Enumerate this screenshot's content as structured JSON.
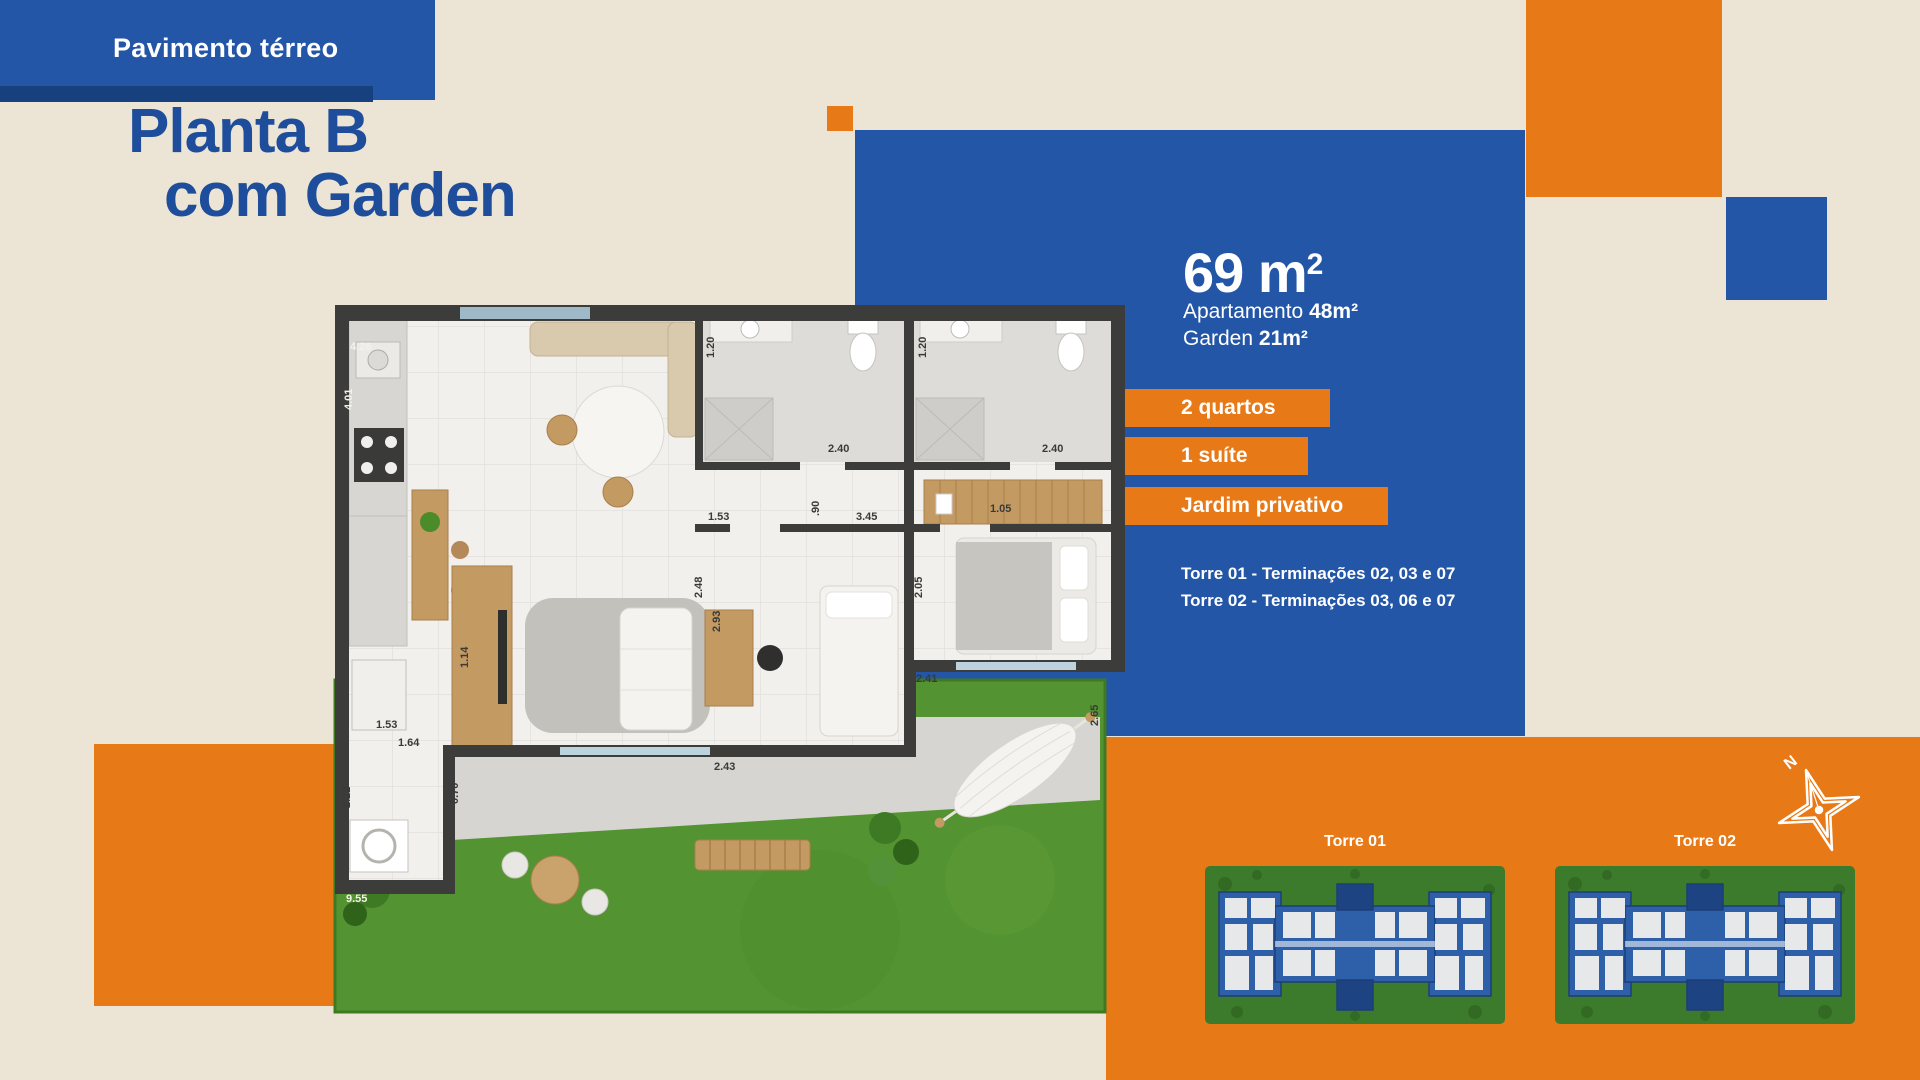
{
  "banner": {
    "label": "Pavimento térreo"
  },
  "title": {
    "line1": "Planta B",
    "line2": "com Garden"
  },
  "info_panel": {
    "area_value": "69 m",
    "area_sup": "2",
    "apartment_label": "Apartamento ",
    "apartment_value": "48m²",
    "garden_label": "Garden ",
    "garden_value": "21m²",
    "badges": [
      "2 quartos",
      "1 suíte",
      "Jardim privativo"
    ],
    "tower_lines": [
      "Torre 01 -  Terminações 02, 03 e 07",
      "Torre 02 -  Terminações 03, 06 e 07"
    ]
  },
  "site_panel": {
    "tower1_label": "Torre 01",
    "tower2_label": "Torre 02",
    "compass_label": "N"
  },
  "floorplan": {
    "measurements": [
      {
        "t": "4.26",
        "x": 50,
        "y": 70,
        "r": 0,
        "c": "w"
      },
      {
        "t": "4.01",
        "x": 52,
        "y": 130,
        "r": -90,
        "c": "w"
      },
      {
        "t": "1.20",
        "x": 414,
        "y": 78,
        "r": -90,
        "c": "d"
      },
      {
        "t": "1.20",
        "x": 626,
        "y": 78,
        "r": -90,
        "c": "d"
      },
      {
        "t": "2.40",
        "x": 528,
        "y": 172,
        "r": 0,
        "c": "d"
      },
      {
        "t": "2.40",
        "x": 742,
        "y": 172,
        "r": 0,
        "c": "d"
      },
      {
        "t": "1.53",
        "x": 408,
        "y": 240,
        "r": 0,
        "c": "d"
      },
      {
        "t": ".90",
        "x": 519,
        "y": 236,
        "r": -90,
        "c": "d"
      },
      {
        "t": "3.45",
        "x": 556,
        "y": 240,
        "r": 0,
        "c": "d"
      },
      {
        "t": "1.05",
        "x": 690,
        "y": 232,
        "r": 0,
        "c": "d"
      },
      {
        "t": "2.48",
        "x": 402,
        "y": 318,
        "r": -90,
        "c": "d"
      },
      {
        "t": "2.93",
        "x": 420,
        "y": 352,
        "r": -90,
        "c": "d"
      },
      {
        "t": "2.05",
        "x": 622,
        "y": 318,
        "r": -90,
        "c": "d"
      },
      {
        "t": "1.14",
        "x": 168,
        "y": 388,
        "r": -90,
        "c": "d"
      },
      {
        "t": "1.53",
        "x": 76,
        "y": 448,
        "r": 0,
        "c": "d"
      },
      {
        "t": "1.64",
        "x": 98,
        "y": 466,
        "r": 0,
        "c": "d"
      },
      {
        "t": "0.70",
        "x": 158,
        "y": 524,
        "r": -90,
        "c": "d"
      },
      {
        "t": "2.22",
        "x": 50,
        "y": 528,
        "r": -90,
        "c": "d"
      },
      {
        "t": "2.43",
        "x": 414,
        "y": 490,
        "r": 0,
        "c": "d"
      },
      {
        "t": "2.41",
        "x": 616,
        "y": 402,
        "r": 0,
        "c": "d"
      },
      {
        "t": "2.65",
        "x": 798,
        "y": 446,
        "r": -90,
        "c": "d"
      },
      {
        "t": "9.55",
        "x": 46,
        "y": 622,
        "r": 0,
        "c": "w"
      }
    ]
  },
  "colors": {
    "background": "#ece4d4",
    "brand_blue": "#2456a7",
    "accent_blue_dark": "#17417e",
    "heading_blue": "#1e4d9c",
    "brand_orange": "#e87917",
    "grass_green": "#549331"
  }
}
